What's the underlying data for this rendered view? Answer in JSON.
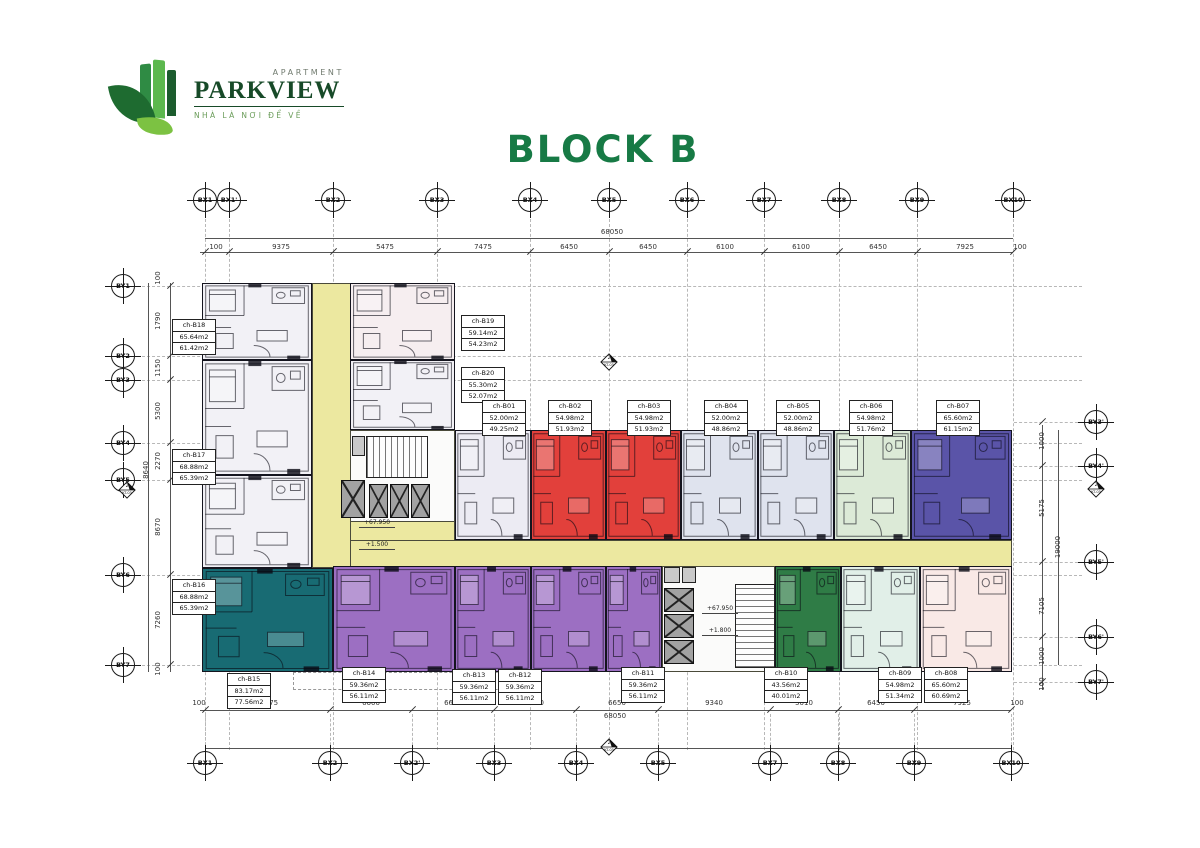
{
  "logo": {
    "apartment": "APARTMENT",
    "name": "PARKVIEW",
    "tagline": "NHÀ LÀ NƠI ĐỂ VỀ"
  },
  "title": "BLOCK B",
  "colors": {
    "title_green": "#177a45",
    "logo_green": "#174a28",
    "corridor_yellow": "#ece8a0",
    "red": "#e2403b",
    "purple": "#9c6fc2",
    "teal": "#186b73",
    "dark_green": "#2f7c46",
    "indigo": "#5a54a8"
  },
  "grid": {
    "top": [
      {
        "label": "BX1",
        "x": 205
      },
      {
        "label": "BX1'",
        "x": 229
      },
      {
        "label": "BX2",
        "x": 333
      },
      {
        "label": "BX3",
        "x": 437
      },
      {
        "label": "BX4",
        "x": 530
      },
      {
        "label": "BX5",
        "x": 609
      },
      {
        "label": "BX6",
        "x": 687
      },
      {
        "label": "BX7",
        "x": 764
      },
      {
        "label": "BX8",
        "x": 839
      },
      {
        "label": "BX9",
        "x": 917
      },
      {
        "label": "BX10",
        "x": 1013
      }
    ],
    "bottom": [
      {
        "label": "BX1",
        "x": 205
      },
      {
        "label": "BX2",
        "x": 330
      },
      {
        "label": "BX2'",
        "x": 412
      },
      {
        "label": "BX3",
        "x": 494
      },
      {
        "label": "BX4",
        "x": 576
      },
      {
        "label": "BX5",
        "x": 658
      },
      {
        "label": "BX7",
        "x": 770
      },
      {
        "label": "BX8",
        "x": 838
      },
      {
        "label": "BX9",
        "x": 914
      },
      {
        "label": "BX10",
        "x": 1011
      }
    ],
    "left": [
      {
        "label": "BY1",
        "y": 286
      },
      {
        "label": "BY2",
        "y": 356
      },
      {
        "label": "BY3",
        "y": 380
      },
      {
        "label": "BY4",
        "y": 443
      },
      {
        "label": "BY5",
        "y": 480
      },
      {
        "label": "BY6",
        "y": 575
      },
      {
        "label": "BY7",
        "y": 665
      }
    ],
    "right": [
      {
        "label": "BY3'",
        "y": 422
      },
      {
        "label": "BY4'",
        "y": 466
      },
      {
        "label": "BY5'",
        "y": 562
      },
      {
        "label": "BY6'",
        "y": 637
      },
      {
        "label": "BY7'",
        "y": 682
      }
    ]
  },
  "dims": {
    "top": [
      {
        "t": "100",
        "x": 216
      },
      {
        "t": "9375",
        "x": 281
      },
      {
        "t": "5475",
        "x": 385
      },
      {
        "t": "7475",
        "x": 483
      },
      {
        "t": "6450",
        "x": 569
      },
      {
        "t": "6450",
        "x": 648
      },
      {
        "t": "6100",
        "x": 725
      },
      {
        "t": "6100",
        "x": 801
      },
      {
        "t": "6450",
        "x": 878
      },
      {
        "t": "7925",
        "x": 965
      },
      {
        "t": "100",
        "x": 1020
      }
    ],
    "top_overall": "68050",
    "bottom": [
      {
        "t": "100",
        "x": 199
      },
      {
        "t": "10375",
        "x": 267
      },
      {
        "t": "6600",
        "x": 371
      },
      {
        "t": "6650",
        "x": 453
      },
      {
        "t": "6650",
        "x": 535
      },
      {
        "t": "6650",
        "x": 617
      },
      {
        "t": "9340",
        "x": 714
      },
      {
        "t": "5010",
        "x": 804
      },
      {
        "t": "6450",
        "x": 876
      },
      {
        "t": "7925",
        "x": 962
      },
      {
        "t": "100",
        "x": 1017
      }
    ],
    "bottom_overall": "68050",
    "left": [
      {
        "t": "100",
        "y": 278
      },
      {
        "t": "1790",
        "y": 321
      },
      {
        "t": "1150",
        "y": 368
      },
      {
        "t": "5300",
        "y": 411
      },
      {
        "t": "2270",
        "y": 461
      },
      {
        "t": "8670",
        "y": 527
      },
      {
        "t": "7260",
        "y": 620
      },
      {
        "t": "100",
        "y": 669
      }
    ],
    "left_outer": "8640",
    "right": [
      {
        "t": "1000",
        "y": 441
      },
      {
        "t": "5175",
        "y": 508
      },
      {
        "t": "7105",
        "y": 606
      },
      {
        "t": "1000",
        "y": 656
      },
      {
        "t": "100",
        "y": 684
      }
    ],
    "right_overall": "19000"
  },
  "zones": [
    {
      "id": "corridor-vertical",
      "x": 312,
      "y": 283,
      "w": 40,
      "h": 285,
      "color": "#ece8a0"
    },
    {
      "id": "corridor-bend",
      "x": 350,
      "y": 518,
      "w": 105,
      "h": 50,
      "color": "#ece8a0"
    },
    {
      "id": "corridor-main",
      "x": 350,
      "y": 540,
      "w": 662,
      "h": 28,
      "color": "#ece8a0"
    },
    {
      "id": "core-1",
      "x": 350,
      "y": 430,
      "w": 105,
      "h": 92,
      "color": "#fbfbfa"
    },
    {
      "id": "core-2",
      "x": 662,
      "y": 566,
      "w": 113,
      "h": 106,
      "color": "#fbfbfa"
    }
  ],
  "units": [
    {
      "id": "ch-B18",
      "x": 202,
      "y": 283,
      "w": 110,
      "h": 77,
      "color": "#f2f1f6"
    },
    {
      "id": "ch-B17",
      "x": 202,
      "y": 360,
      "w": 110,
      "h": 115,
      "color": "#f2f1f6"
    },
    {
      "id": "ch-B16",
      "x": 202,
      "y": 475,
      "w": 110,
      "h": 93,
      "color": "#f2f1f6"
    },
    {
      "id": "ch-B19",
      "x": 350,
      "y": 283,
      "w": 105,
      "h": 77,
      "color": "#f6eef0"
    },
    {
      "id": "ch-B20",
      "x": 350,
      "y": 360,
      "w": 105,
      "h": 70,
      "color": "#f2f1f6"
    },
    {
      "id": "ch-B01",
      "x": 455,
      "y": 430,
      "w": 76,
      "h": 110,
      "color": "#ecebf3"
    },
    {
      "id": "ch-B02",
      "x": 531,
      "y": 430,
      "w": 75,
      "h": 110,
      "color": "#e2403b"
    },
    {
      "id": "ch-B03",
      "x": 606,
      "y": 430,
      "w": 75,
      "h": 110,
      "color": "#e2403b"
    },
    {
      "id": "ch-B04",
      "x": 681,
      "y": 430,
      "w": 77,
      "h": 110,
      "color": "#dfe3ee"
    },
    {
      "id": "ch-B05",
      "x": 758,
      "y": 430,
      "w": 76,
      "h": 110,
      "color": "#dfe3ee"
    },
    {
      "id": "ch-B06",
      "x": 834,
      "y": 430,
      "w": 77,
      "h": 110,
      "color": "#dcead7"
    },
    {
      "id": "ch-B07",
      "x": 911,
      "y": 430,
      "w": 101,
      "h": 110,
      "color": "#5a54a8"
    },
    {
      "id": "ch-B15",
      "x": 202,
      "y": 568,
      "w": 131,
      "h": 104,
      "color": "#186b73"
    },
    {
      "id": "ch-B14",
      "x": 333,
      "y": 566,
      "w": 122,
      "h": 106,
      "color": "#9c6fc2"
    },
    {
      "id": "ch-B13",
      "x": 455,
      "y": 566,
      "w": 76,
      "h": 106,
      "color": "#9c6fc2"
    },
    {
      "id": "ch-B12",
      "x": 531,
      "y": 566,
      "w": 75,
      "h": 106,
      "color": "#9c6fc2"
    },
    {
      "id": "ch-B11",
      "x": 606,
      "y": 566,
      "w": 56,
      "h": 106,
      "color": "#9c6fc2"
    },
    {
      "id": "ch-B10",
      "x": 775,
      "y": 566,
      "w": 66,
      "h": 106,
      "color": "#2f7c46"
    },
    {
      "id": "ch-B09",
      "x": 841,
      "y": 566,
      "w": 79,
      "h": 106,
      "color": "#e1efe8"
    },
    {
      "id": "ch-B08",
      "x": 920,
      "y": 566,
      "w": 92,
      "h": 106,
      "color": "#f9e9e6"
    }
  ],
  "unit_labels": [
    {
      "name": "ch-B18",
      "area1": "65.64m2",
      "area2": "61.42m2",
      "x": 172,
      "y": 320
    },
    {
      "name": "ch-B17",
      "area1": "68.88m2",
      "area2": "65.39m2",
      "x": 172,
      "y": 450
    },
    {
      "name": "ch-B16",
      "area1": "68.88m2",
      "area2": "65.39m2",
      "x": 172,
      "y": 580
    },
    {
      "name": "ch-B19",
      "area1": "59.14m2",
      "area2": "54.23m2",
      "x": 461,
      "y": 316
    },
    {
      "name": "ch-B20",
      "area1": "55.30m2",
      "area2": "52.07m2",
      "x": 461,
      "y": 368
    },
    {
      "name": "ch-B01",
      "area1": "52.00m2",
      "area2": "49.25m2",
      "x": 482,
      "y": 401
    },
    {
      "name": "ch-B02",
      "area1": "54.98m2",
      "area2": "51.93m2",
      "x": 548,
      "y": 401
    },
    {
      "name": "ch-B03",
      "area1": "54.98m2",
      "area2": "51.93m2",
      "x": 627,
      "y": 401
    },
    {
      "name": "ch-B04",
      "area1": "52.00m2",
      "area2": "48.86m2",
      "x": 704,
      "y": 401
    },
    {
      "name": "ch-B05",
      "area1": "52.00m2",
      "area2": "48.86m2",
      "x": 776,
      "y": 401
    },
    {
      "name": "ch-B06",
      "area1": "54.98m2",
      "area2": "51.76m2",
      "x": 849,
      "y": 401
    },
    {
      "name": "ch-B07",
      "area1": "65.60m2",
      "area2": "61.15m2",
      "x": 936,
      "y": 401
    },
    {
      "name": "ch-B15",
      "area1": "83.17m2",
      "area2": "77.56m2",
      "x": 227,
      "y": 674
    },
    {
      "name": "ch-B14",
      "area1": "59.36m2",
      "area2": "56.11m2",
      "x": 342,
      "y": 668
    },
    {
      "name": "ch-B13",
      "area1": "59.36m2",
      "area2": "56.11m2",
      "x": 452,
      "y": 670
    },
    {
      "name": "ch-B12",
      "area1": "59.36m2",
      "area2": "56.11m2",
      "x": 498,
      "y": 670
    },
    {
      "name": "ch-B11",
      "area1": "59.36m2",
      "area2": "56.11m2",
      "x": 621,
      "y": 668
    },
    {
      "name": "ch-B10",
      "area1": "43.56m2",
      "area2": "40.01m2",
      "x": 764,
      "y": 668
    },
    {
      "name": "ch-B09",
      "area1": "54.98m2",
      "area2": "51.34m2",
      "x": 878,
      "y": 668
    },
    {
      "name": "ch-B08",
      "area1": "65.60m2",
      "area2": "60.69m2",
      "x": 924,
      "y": 668
    }
  ],
  "levels": [
    {
      "t": "+67.950",
      "x": 377,
      "y": 519
    },
    {
      "t": "+1.500",
      "x": 377,
      "y": 541
    },
    {
      "t": "+67.950",
      "x": 720,
      "y": 605
    },
    {
      "t": "+1.800",
      "x": 720,
      "y": 627
    }
  ],
  "sections": [
    {
      "num": "2",
      "ref": "KT-03",
      "x": 600,
      "y": 353
    },
    {
      "num": "2",
      "ref": "KT-03",
      "x": 600,
      "y": 738
    },
    {
      "num": "2",
      "ref": "KT-03",
      "x": 118,
      "y": 481
    },
    {
      "num": "2",
      "ref": "KT-03",
      "x": 1087,
      "y": 480
    }
  ]
}
